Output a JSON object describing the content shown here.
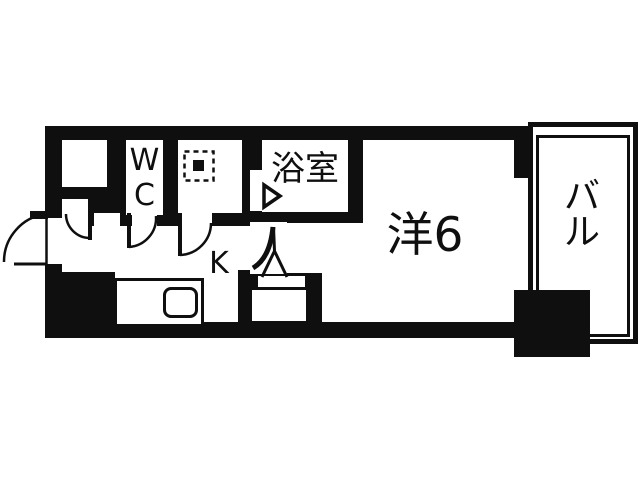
{
  "page": {
    "background": "#ffffff",
    "ink": "#0f0f0f"
  },
  "floorplan": {
    "type": "japanese-apartment-floor-plan",
    "rooms": {
      "wc": {
        "label": "WC"
      },
      "bathroom": {
        "label": "浴室"
      },
      "western_room": {
        "label": "洋6",
        "size_tatami": 6
      },
      "kitchen": {
        "label": "K"
      },
      "balcony": {
        "label": "バル"
      }
    },
    "features": [
      "entrance-door-swing-arc",
      "entry-closet",
      "washing-machine-space-symbol",
      "three-interior-door-arcs",
      "bathroom-door-triangle",
      "kitchen-counter-with-sink",
      "washbasin-unit",
      "window-opening-to-balcony"
    ]
  }
}
